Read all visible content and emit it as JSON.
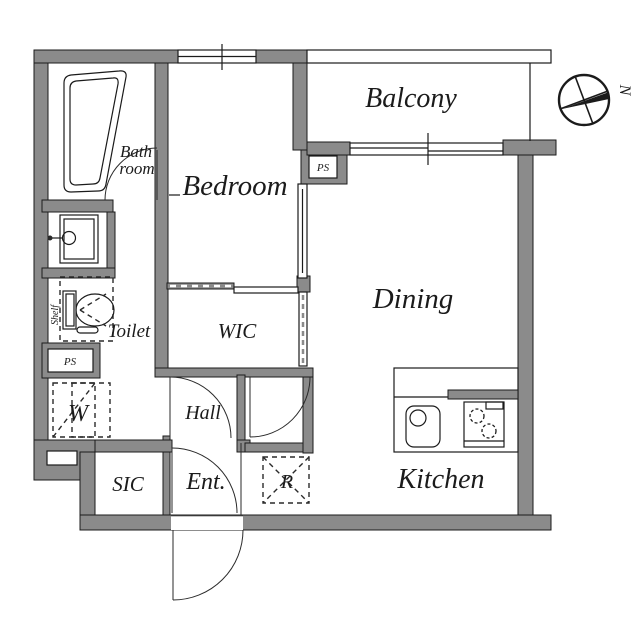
{
  "plan": {
    "rooms": {
      "balcony": "Balcony",
      "bedroom": "Bedroom",
      "dining": "Dining",
      "kitchen": "Kitchen",
      "bath_line1": "Bath",
      "bath_line2": "room",
      "toilet": "Toilet",
      "wic": "WIC",
      "hall": "Hall",
      "entrance": "Ent.",
      "sic": "SIC"
    },
    "equipment": {
      "washer": "W",
      "refrigerator": "R",
      "shelf": "Shelf",
      "pipe_shaft_left": "PS",
      "pipe_shaft_balcony": "PS"
    },
    "compass": {
      "north_label": "N"
    },
    "colors": {
      "wall_fill": "#8b8b8b",
      "line": "#1b1b1b",
      "background": "#ffffff"
    }
  }
}
